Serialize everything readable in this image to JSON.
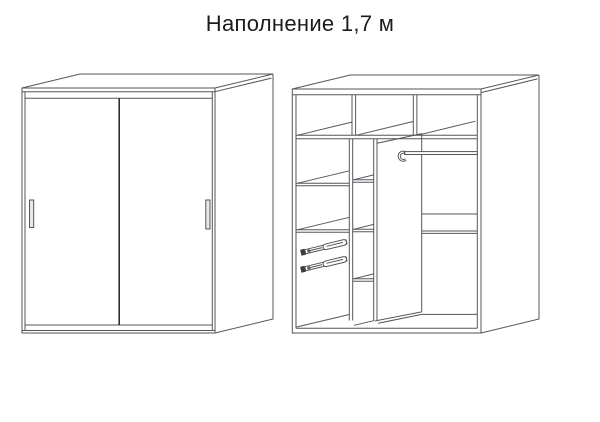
{
  "page": {
    "title": "Наполнение 1,7 м",
    "background_color": "#ffffff",
    "title_color": "#1c1c1c"
  },
  "diagram": {
    "line_color": "#55565a",
    "dark_line_color": "#2f2f31",
    "handle_fill": "#e8e8e8",
    "views": {
      "left": "wardrobe-closed-front-view",
      "right": "wardrobe-interior-filling-view"
    }
  }
}
